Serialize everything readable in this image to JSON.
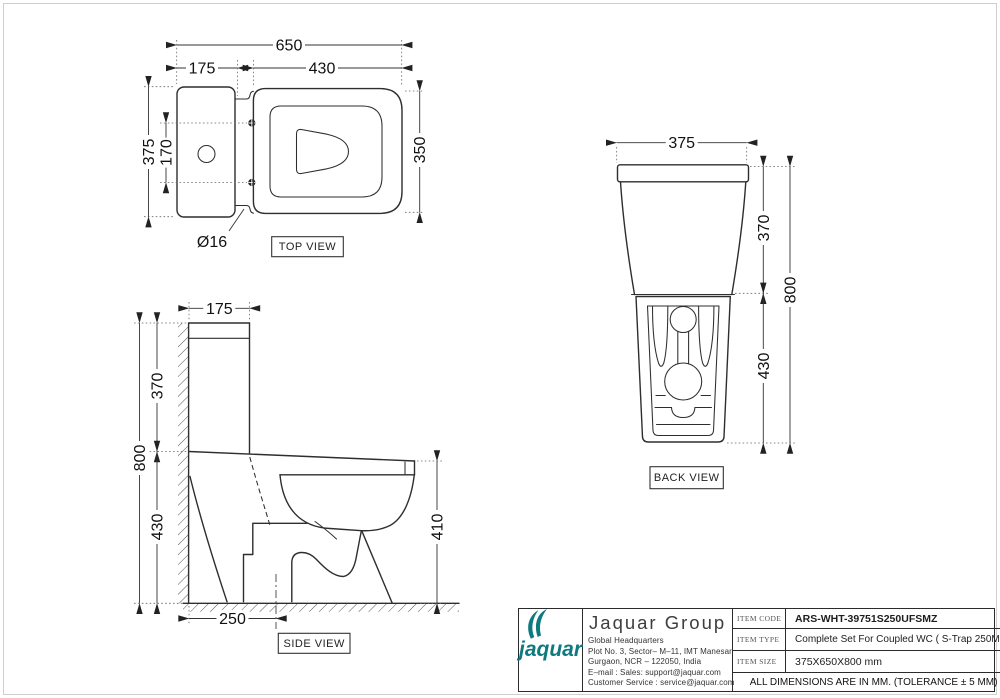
{
  "views": {
    "top": {
      "label": "TOP VIEW",
      "dims": {
        "overall_width": "650",
        "tank_width": "175",
        "seat_width": "430",
        "overall_depth": "375",
        "bolt_spacing": "170",
        "seat_depth": "350",
        "hole_dia": "Ø16"
      }
    },
    "side": {
      "label": "SIDE VIEW",
      "dims": {
        "tank_depth": "175",
        "tank_height": "370",
        "total_height": "800",
        "bowl_height": "430",
        "rim_height": "410",
        "trap_distance": "250"
      }
    },
    "back": {
      "label": "BACK VIEW",
      "dims": {
        "width": "375",
        "tank_height": "370",
        "total_height": "800",
        "bowl_height": "430"
      }
    }
  },
  "title_block": {
    "company": "Jaquar Group",
    "logo_text": "jaquar",
    "address_lines": [
      "Global Headquarters",
      "Plot No. 3, Sector– M–11, IMT Manesar",
      "Gurgaon, NCR – 122050, India",
      "E–mail : Sales: support@jaquar.com",
      "Customer Service : service@jaquar.com"
    ],
    "rows": [
      {
        "label": "ITEM CODE",
        "value": "ARS-WHT-39751S250UFSMZ"
      },
      {
        "label": "ITEM TYPE",
        "value": "Complete Set For Coupled WC ( S-Trap 250MM )"
      },
      {
        "label": "ITEM SIZE",
        "value": "375X650X800 mm"
      }
    ],
    "note": "ALL DIMENSIONS ARE IN MM. (TOLERANCE ± 5 MM)"
  }
}
